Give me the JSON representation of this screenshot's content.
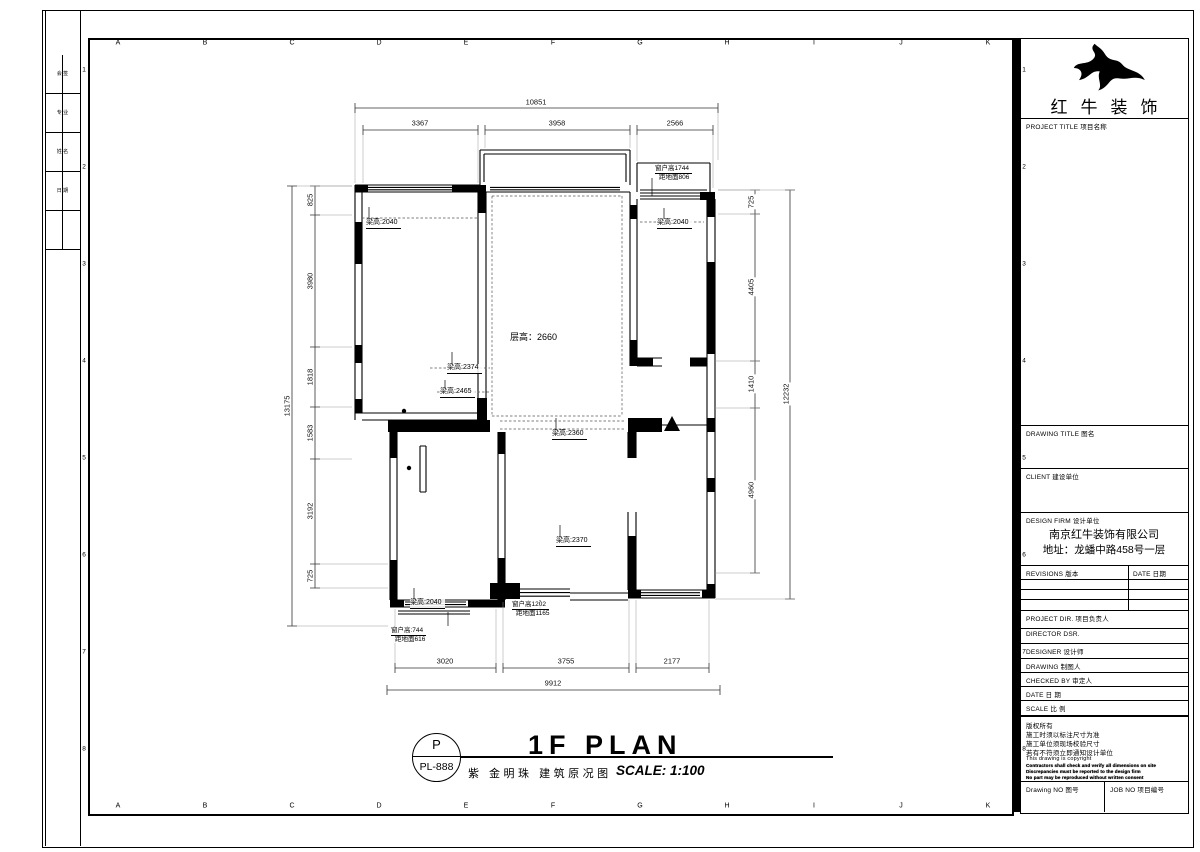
{
  "frame": {
    "grid_letters": [
      "A",
      "B",
      "C",
      "D",
      "E",
      "F",
      "G",
      "H",
      "I",
      "J",
      "K"
    ],
    "row_numbers": [
      "1",
      "2",
      "3",
      "4",
      "5",
      "6",
      "7",
      "8"
    ],
    "countersign_cells": [
      "会 签",
      "专 业",
      "姓 名",
      "日 期",
      ""
    ]
  },
  "title_bar": {
    "stamp_top": "P",
    "stamp_bottom": "PL-888",
    "title": "1F PLAN",
    "subtitle": "紫 金明珠 建筑原况图",
    "scale_text": "SCALE: 1:100"
  },
  "title_block": {
    "logo_text": "红牛装饰",
    "project_title_label": "PROJECT TITLE 项目名称",
    "drawing_title_label": "DRAWING TITLE 图名",
    "client_label": "CLIENT 建设单位",
    "design_firm_label": "DESIGN FIRM 设计单位",
    "design_firm_name": "南京红牛装饰有限公司",
    "design_firm_address": "地址：龙蟠中路458号一层",
    "revisions_label": "REVISIONS 版本",
    "date_col_label": "DATE 日期",
    "project_dir_label": "PROJECT DIR. 项目负责人",
    "director_label": "DIRECTOR DSR.",
    "designer_label": "DESIGNER  设计师",
    "drawing_label": "DRAWING  制图人",
    "checked_by_label": "CHECKED BY  审定人",
    "date_label": "DATE  日 期",
    "scale_label": "SCALE  比 例",
    "copyright_line1": "版权所有",
    "copyright_line2": "施工时须以标注尺寸为准",
    "copyright_line3": "施工单位须现场校验尺寸",
    "copyright_line4": "若有不符须立即通知设计单位",
    "copyright_line5": "This drawing is copyright",
    "fineprint1": "Contractors shall check and verify all dimensions on site",
    "fineprint2": "Discrepancies must be reported to the design firm",
    "fineprint3": "No part may be reproduced without written consent",
    "drawing_no_label": "Drawing NO 图号",
    "job_no_label": "JOB NO 项目编号"
  },
  "plan": {
    "room_height_label": "层高：2660",
    "beam_tl": "梁高:2040",
    "beam_tr": "梁高:2040",
    "beam_mid1": "梁高:2374",
    "beam_mid2": "梁高:2465",
    "beam_mid3": "梁高:2360",
    "beam_bm": "梁高:2370",
    "beam_bl": "梁高:2040",
    "win_tr_line1": "窗户高1744",
    "win_tr_line2": "距地面806",
    "win_bl_line1": "窗户高:744",
    "win_bl_line2": "距地面616",
    "win_bm_line1": "窗户高1202",
    "win_bm_line2": "距地面1165",
    "dims": {
      "top_total": "10851",
      "top_segments": [
        "3367",
        "3958",
        "2566"
      ],
      "left_total": "13175",
      "left_segments": [
        "825",
        "3980",
        "1818",
        "1583",
        "3192",
        "725"
      ],
      "right_total": "12232",
      "right_segments": [
        "725",
        "4405",
        "1410",
        "4960"
      ],
      "bottom_total": "9912",
      "bottom_segments": [
        "3020",
        "3755",
        "2177"
      ]
    }
  }
}
